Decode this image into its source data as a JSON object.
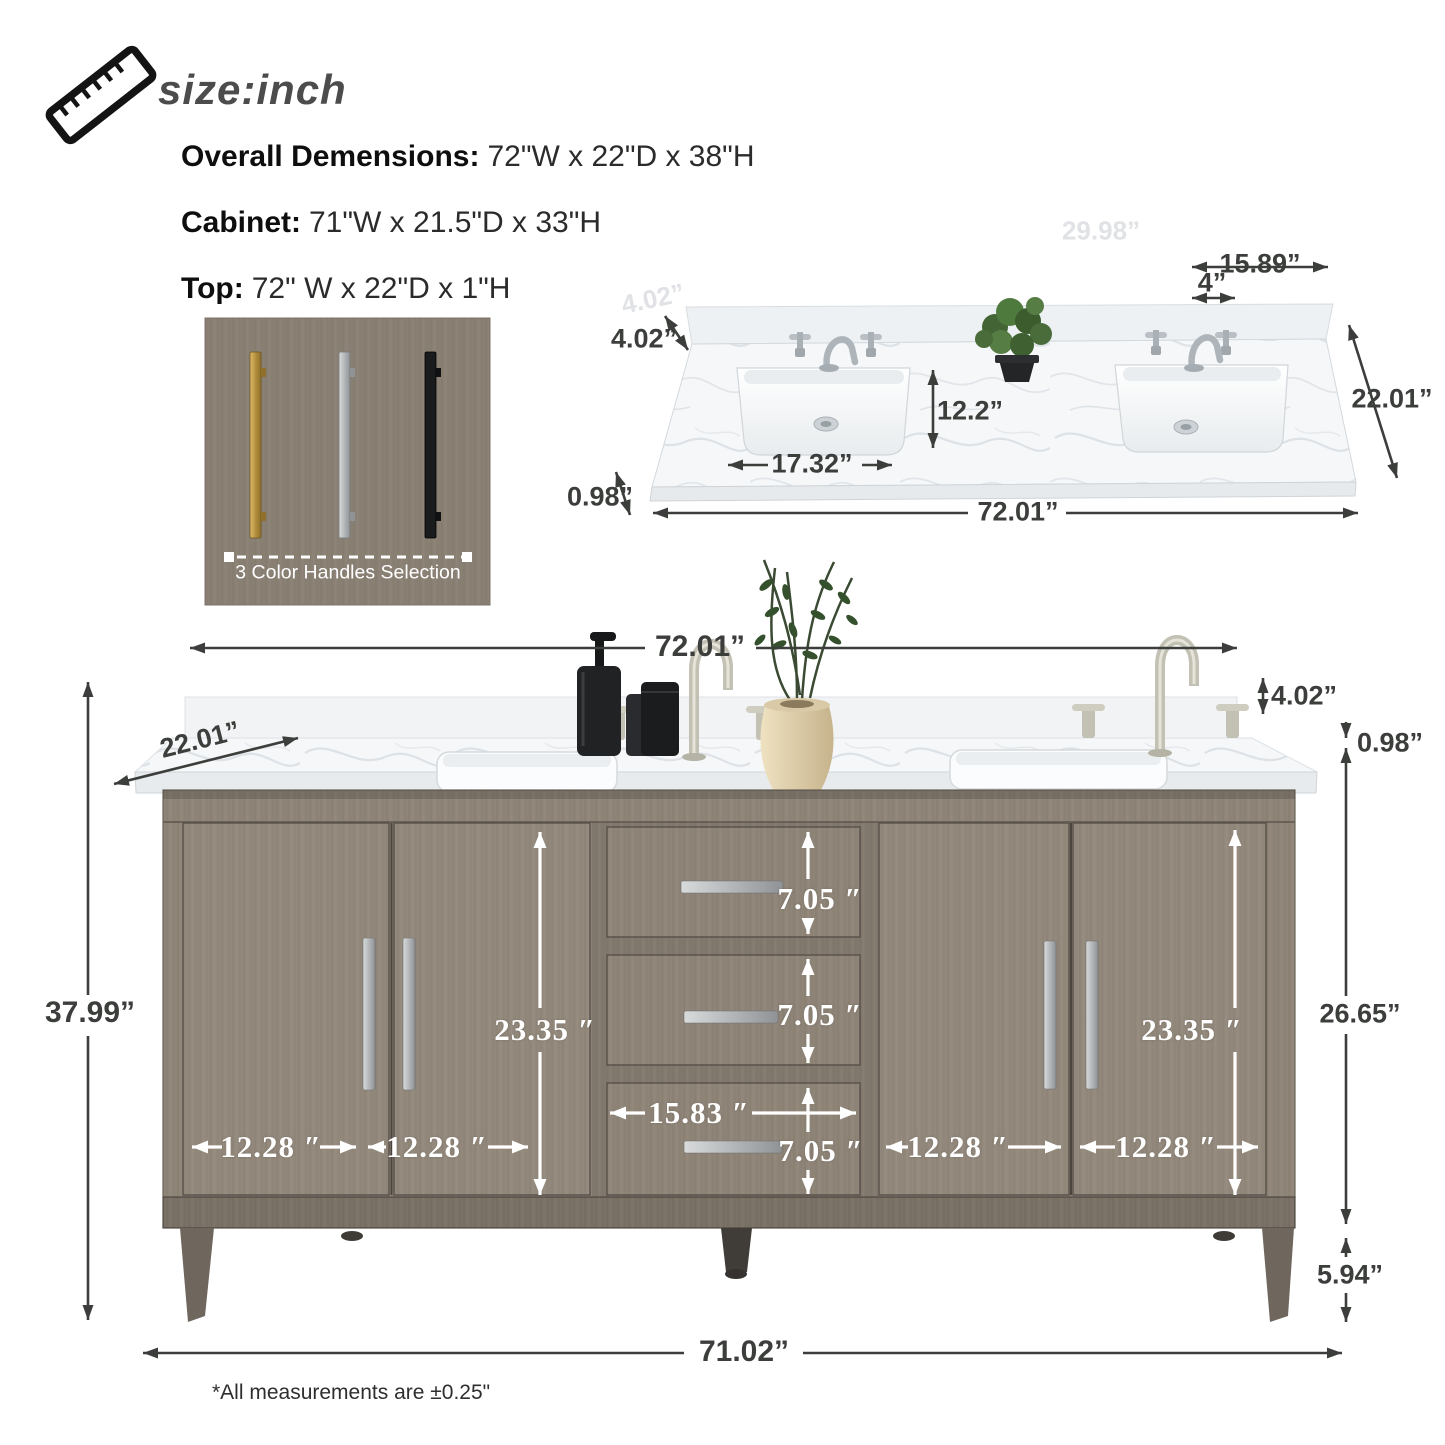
{
  "header": {
    "icon": "ruler-icon",
    "title": "size:inch"
  },
  "specs": [
    {
      "label": "Overall Demensions:",
      "value": "72\"W x 22\"D x 38\"H"
    },
    {
      "label": "Cabinet:",
      "value": "71\"W x 21.5\"D x 33\"H"
    },
    {
      "label": "Top:",
      "value": "72\" W x 22\"D x 1\"H"
    }
  ],
  "handles_panel": {
    "caption": "3 Color Handles Selection",
    "options": [
      "gold",
      "silver",
      "black"
    ]
  },
  "countertop": {
    "dims": {
      "top_width": "15.89”",
      "hole_spacing": "4”",
      "backsplash_height": "4.02”",
      "sink_depth": "12.2”",
      "sink_width": "17.32”",
      "thickness": "0.98”",
      "width": "72.01”",
      "depth": "22.01”"
    },
    "ghost": {
      "g1": "29.98”",
      "g2": "4.02”"
    }
  },
  "vanity": {
    "dims": {
      "width": "72.01”",
      "depth": "22.01”",
      "backsplash_height": "4.02”",
      "thickness": "0.98”",
      "height": "37.99”",
      "door_height_left": "23.35 ″",
      "door_height_right": "23.35 ″",
      "drawer1": "7.05 ″",
      "drawer2": "7.05 ″",
      "drawer3": "7.05 ″",
      "drawer_width": "15.83 ″",
      "door1": "12.28 ″",
      "door2": "12.28 ″",
      "door3": "12.28 ″",
      "door4": "12.28 ″",
      "cabinet_side": "26.65”",
      "leg": "5.94”",
      "bottom_width": "71.02”"
    }
  },
  "footnote": "*All measurements are ±0.25\"",
  "colors": {
    "wood": "#8e8478",
    "accent_dark": "#3b3e3b",
    "gold": "#b5913f",
    "silver": "#b9bcbe",
    "black": "#1d1e20",
    "marble": "#f5f7f8"
  }
}
